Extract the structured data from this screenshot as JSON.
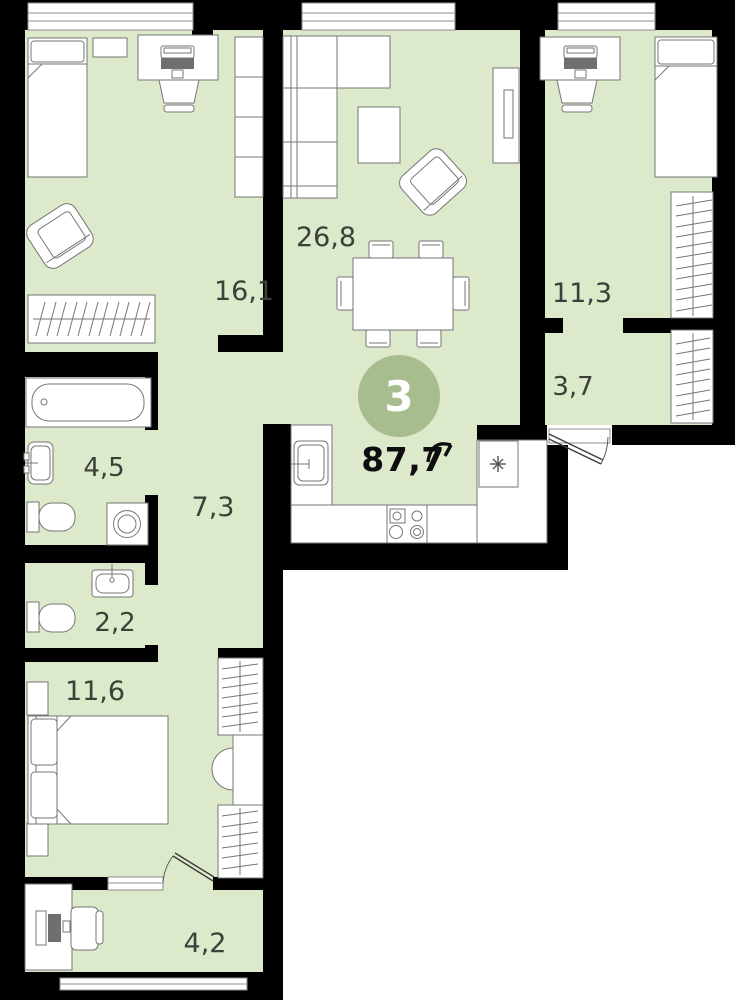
{
  "plan": {
    "badge": {
      "rooms_count": "3",
      "color": "#a7bd8e"
    },
    "total_area": "87,7",
    "colors": {
      "floor": "#dde9cb",
      "wall": "#000000",
      "furniture": "#767676",
      "label": "#3a4138",
      "total": "#0d0d0d",
      "window": "#8f8f8f"
    },
    "rooms": [
      {
        "name": "bedroom-top-left",
        "area": "16,1"
      },
      {
        "name": "living-kitchen",
        "area": "26,8"
      },
      {
        "name": "bedroom-top-right",
        "area": "11,3"
      },
      {
        "name": "hallway",
        "area": "3,7"
      },
      {
        "name": "bathroom",
        "area": "4,5"
      },
      {
        "name": "corridor",
        "area": "7,3"
      },
      {
        "name": "wc",
        "area": "2,2"
      },
      {
        "name": "bedroom-bottom",
        "area": "11,6"
      },
      {
        "name": "loggia",
        "area": "4,2"
      }
    ]
  }
}
